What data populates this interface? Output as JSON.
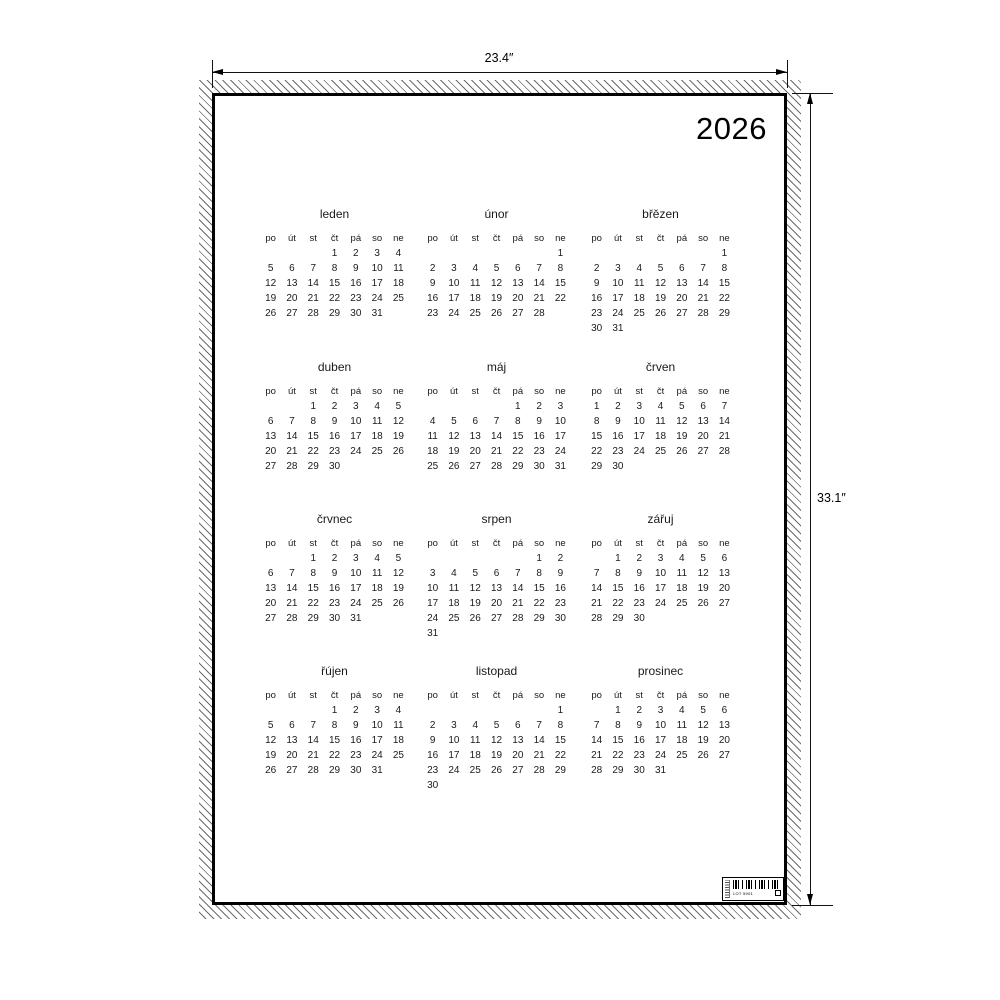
{
  "drawing": {
    "width_label": "23.4″",
    "height_label": "33.1″"
  },
  "poster": {
    "year": "2026"
  },
  "calendar": {
    "day_headers": [
      "po",
      "út",
      "st",
      "čt",
      "pá",
      "so",
      "ne"
    ],
    "months": [
      {
        "name": "leden",
        "weeks": [
          [
            "",
            "",
            "",
            "1",
            "2",
            "3",
            "4"
          ],
          [
            "5",
            "6",
            "7",
            "8",
            "9",
            "10",
            "11"
          ],
          [
            "12",
            "13",
            "14",
            "15",
            "16",
            "17",
            "18"
          ],
          [
            "19",
            "20",
            "21",
            "22",
            "23",
            "24",
            "25"
          ],
          [
            "26",
            "27",
            "28",
            "29",
            "30",
            "31",
            ""
          ]
        ]
      },
      {
        "name": "únor",
        "weeks": [
          [
            "",
            "",
            "",
            "",
            "",
            "",
            "1"
          ],
          [
            "2",
            "3",
            "4",
            "5",
            "6",
            "7",
            "8"
          ],
          [
            "9",
            "10",
            "11",
            "12",
            "13",
            "14",
            "15"
          ],
          [
            "16",
            "17",
            "18",
            "19",
            "20",
            "21",
            "22"
          ],
          [
            "23",
            "24",
            "25",
            "26",
            "27",
            "28",
            ""
          ]
        ]
      },
      {
        "name": "břězen",
        "weeks": [
          [
            "",
            "",
            "",
            "",
            "",
            "",
            "1"
          ],
          [
            "2",
            "3",
            "4",
            "5",
            "6",
            "7",
            "8"
          ],
          [
            "9",
            "10",
            "11",
            "12",
            "13",
            "14",
            "15"
          ],
          [
            "16",
            "17",
            "18",
            "19",
            "20",
            "21",
            "22"
          ],
          [
            "23",
            "24",
            "25",
            "26",
            "27",
            "28",
            "29"
          ],
          [
            "30",
            "31",
            "",
            "",
            "",
            "",
            ""
          ]
        ]
      },
      {
        "name": "duben",
        "weeks": [
          [
            "",
            "",
            "1",
            "2",
            "3",
            "4",
            "5"
          ],
          [
            "6",
            "7",
            "8",
            "9",
            "10",
            "11",
            "12"
          ],
          [
            "13",
            "14",
            "15",
            "16",
            "17",
            "18",
            "19"
          ],
          [
            "20",
            "21",
            "22",
            "23",
            "24",
            "25",
            "26"
          ],
          [
            "27",
            "28",
            "29",
            "30",
            "",
            "",
            ""
          ]
        ]
      },
      {
        "name": "máj",
        "weeks": [
          [
            "",
            "",
            "",
            "",
            "1",
            "2",
            "3"
          ],
          [
            "4",
            "5",
            "6",
            "7",
            "8",
            "9",
            "10"
          ],
          [
            "11",
            "12",
            "13",
            "14",
            "15",
            "16",
            "17"
          ],
          [
            "18",
            "19",
            "20",
            "21",
            "22",
            "23",
            "24"
          ],
          [
            "25",
            "26",
            "27",
            "28",
            "29",
            "30",
            "31"
          ]
        ]
      },
      {
        "name": "črven",
        "weeks": [
          [
            "1",
            "2",
            "3",
            "4",
            "5",
            "6",
            "7"
          ],
          [
            "8",
            "9",
            "10",
            "11",
            "12",
            "13",
            "14"
          ],
          [
            "15",
            "16",
            "17",
            "18",
            "19",
            "20",
            "21"
          ],
          [
            "22",
            "23",
            "24",
            "25",
            "26",
            "27",
            "28"
          ],
          [
            "29",
            "30",
            "",
            "",
            "",
            "",
            ""
          ]
        ]
      },
      {
        "name": "črvnec",
        "weeks": [
          [
            "",
            "",
            "1",
            "2",
            "3",
            "4",
            "5"
          ],
          [
            "6",
            "7",
            "8",
            "9",
            "10",
            "11",
            "12"
          ],
          [
            "13",
            "14",
            "15",
            "16",
            "17",
            "18",
            "19"
          ],
          [
            "20",
            "21",
            "22",
            "23",
            "24",
            "25",
            "26"
          ],
          [
            "27",
            "28",
            "29",
            "30",
            "31",
            "",
            ""
          ]
        ]
      },
      {
        "name": "srpen",
        "weeks": [
          [
            "",
            "",
            "",
            "",
            "",
            "1",
            "2"
          ],
          [
            "3",
            "4",
            "5",
            "6",
            "7",
            "8",
            "9"
          ],
          [
            "10",
            "11",
            "12",
            "13",
            "14",
            "15",
            "16"
          ],
          [
            "17",
            "18",
            "19",
            "20",
            "21",
            "22",
            "23"
          ],
          [
            "24",
            "25",
            "26",
            "27",
            "28",
            "29",
            "30"
          ],
          [
            "31",
            "",
            "",
            "",
            "",
            "",
            ""
          ]
        ]
      },
      {
        "name": "zářuj",
        "weeks": [
          [
            "",
            "1",
            "2",
            "3",
            "4",
            "5",
            "6"
          ],
          [
            "7",
            "8",
            "9",
            "10",
            "11",
            "12",
            "13"
          ],
          [
            "14",
            "15",
            "16",
            "17",
            "18",
            "19",
            "20"
          ],
          [
            "21",
            "22",
            "23",
            "24",
            "25",
            "26",
            "27"
          ],
          [
            "28",
            "29",
            "30",
            "",
            "",
            "",
            ""
          ]
        ]
      },
      {
        "name": "řújen",
        "weeks": [
          [
            "",
            "",
            "",
            "1",
            "2",
            "3",
            "4"
          ],
          [
            "5",
            "6",
            "7",
            "8",
            "9",
            "10",
            "11"
          ],
          [
            "12",
            "13",
            "14",
            "15",
            "16",
            "17",
            "18"
          ],
          [
            "19",
            "20",
            "21",
            "22",
            "23",
            "24",
            "25"
          ],
          [
            "26",
            "27",
            "28",
            "29",
            "30",
            "31",
            ""
          ]
        ]
      },
      {
        "name": "listopad",
        "weeks": [
          [
            "",
            "",
            "",
            "",
            "",
            "",
            "1"
          ],
          [
            "2",
            "3",
            "4",
            "5",
            "6",
            "7",
            "8"
          ],
          [
            "9",
            "10",
            "11",
            "12",
            "13",
            "14",
            "15"
          ],
          [
            "16",
            "17",
            "18",
            "19",
            "20",
            "21",
            "22"
          ],
          [
            "23",
            "24",
            "25",
            "26",
            "27",
            "28",
            "29"
          ],
          [
            "30",
            "",
            "",
            "",
            "",
            "",
            ""
          ]
        ]
      },
      {
        "name": "prosinec",
        "weeks": [
          [
            "",
            "1",
            "2",
            "3",
            "4",
            "5",
            "6"
          ],
          [
            "7",
            "8",
            "9",
            "10",
            "11",
            "12",
            "13"
          ],
          [
            "14",
            "15",
            "16",
            "17",
            "18",
            "19",
            "20"
          ],
          [
            "21",
            "22",
            "23",
            "24",
            "25",
            "26",
            "27"
          ],
          [
            "28",
            "29",
            "30",
            "31",
            "",
            "",
            ""
          ]
        ]
      }
    ]
  },
  "tag": {
    "lot_text": "LOT 5901",
    "box_glyph": "□"
  }
}
